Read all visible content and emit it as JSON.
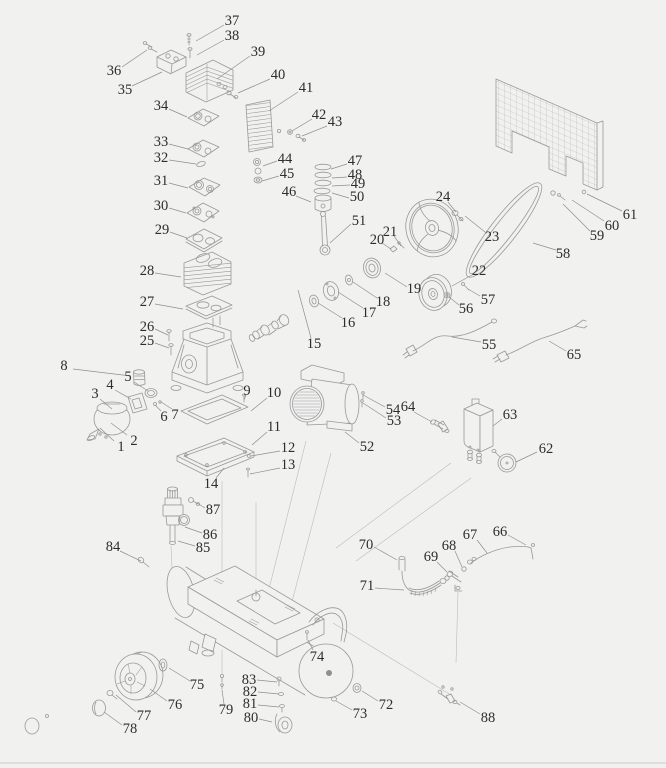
{
  "diagram": {
    "subject": "Air compressor exploded parts diagram",
    "type": "exploded-parts-diagram",
    "part_count": 88,
    "background_color": "#f1f1ef",
    "part_line_color": "#97999b",
    "leader_line_color": "#8d8f91",
    "construction_line_color": "#bcbcba",
    "label_color": "#2d2d2d",
    "label_font_size": 14.5,
    "bottom_rule_color": "#c9c9c7",
    "labels": [
      {
        "n": "1",
        "x": 121,
        "y": 447,
        "l": [
          114,
          441,
          100,
          428
        ]
      },
      {
        "n": "2",
        "x": 134,
        "y": 441,
        "l": [
          127,
          435,
          111,
          423
        ]
      },
      {
        "n": "3",
        "x": 95,
        "y": 394,
        "l": [
          100,
          399,
          112,
          409
        ]
      },
      {
        "n": "4",
        "x": 110,
        "y": 385,
        "l": [
          115,
          390,
          131,
          399
        ]
      },
      {
        "n": "5",
        "x": 128,
        "y": 377,
        "l": [
          134,
          382,
          148,
          391
        ]
      },
      {
        "n": "6",
        "x": 164,
        "y": 417,
        "l": [
          161,
          411,
          155,
          405
        ]
      },
      {
        "n": "7",
        "x": 175,
        "y": 415,
        "l": [
          172,
          409,
          161,
          402
        ]
      },
      {
        "n": "8",
        "x": 64,
        "y": 366,
        "l": [
          73,
          369,
          131,
          376
        ]
      },
      {
        "n": "9",
        "x": 247,
        "y": 391,
        "l": [
          246,
          395,
          244,
          400
        ]
      },
      {
        "n": "10",
        "x": 274,
        "y": 393,
        "l": [
          267,
          398,
          251,
          411
        ]
      },
      {
        "n": "11",
        "x": 274,
        "y": 427,
        "l": [
          267,
          432,
          252,
          445
        ]
      },
      {
        "n": "12",
        "x": 288,
        "y": 448,
        "l": [
          280,
          451,
          251,
          456
        ]
      },
      {
        "n": "13",
        "x": 288,
        "y": 465,
        "l": [
          280,
          468,
          250,
          474
        ]
      },
      {
        "n": "14",
        "x": 211,
        "y": 484,
        "l": [
          216,
          478,
          224,
          468
        ]
      },
      {
        "n": "15",
        "x": 314,
        "y": 344,
        "l": [
          311,
          338,
          298,
          290
        ]
      },
      {
        "n": "16",
        "x": 348,
        "y": 323,
        "l": [
          342,
          318,
          318,
          303
        ]
      },
      {
        "n": "17",
        "x": 369,
        "y": 313,
        "l": [
          363,
          308,
          338,
          292
        ]
      },
      {
        "n": "18",
        "x": 383,
        "y": 302,
        "l": [
          377,
          298,
          353,
          282
        ]
      },
      {
        "n": "19",
        "x": 414,
        "y": 289,
        "l": [
          407,
          287,
          385,
          273
        ]
      },
      {
        "n": "20",
        "x": 377,
        "y": 240,
        "l": [
          382,
          243,
          391,
          249
        ]
      },
      {
        "n": "21",
        "x": 390,
        "y": 232,
        "l": [
          394,
          236,
          401,
          246
        ]
      },
      {
        "n": "22",
        "x": 479,
        "y": 271,
        "l": [
          472,
          275,
          452,
          286
        ]
      },
      {
        "n": "23",
        "x": 492,
        "y": 237,
        "l": [
          485,
          232,
          465,
          216
        ]
      },
      {
        "n": "24",
        "x": 443,
        "y": 197,
        "l": [
          448,
          202,
          456,
          212
        ]
      },
      {
        "n": "25",
        "x": 147,
        "y": 341,
        "l": [
          155,
          343,
          169,
          348
        ]
      },
      {
        "n": "26",
        "x": 147,
        "y": 327,
        "l": [
          155,
          329,
          168,
          335
        ]
      },
      {
        "n": "27",
        "x": 147,
        "y": 302,
        "l": [
          155,
          304,
          183,
          309
        ]
      },
      {
        "n": "28",
        "x": 147,
        "y": 271,
        "l": [
          155,
          273,
          181,
          277
        ]
      },
      {
        "n": "29",
        "x": 162,
        "y": 230,
        "l": [
          170,
          232,
          187,
          238
        ]
      },
      {
        "n": "30",
        "x": 161,
        "y": 206,
        "l": [
          169,
          208,
          186,
          213
        ]
      },
      {
        "n": "31",
        "x": 161,
        "y": 181,
        "l": [
          169,
          183,
          188,
          188
        ]
      },
      {
        "n": "32",
        "x": 161,
        "y": 158,
        "l": [
          169,
          160,
          196,
          164
        ]
      },
      {
        "n": "33",
        "x": 161,
        "y": 142,
        "l": [
          169,
          144,
          188,
          149
        ]
      },
      {
        "n": "34",
        "x": 161,
        "y": 106,
        "l": [
          169,
          109,
          187,
          117
        ]
      },
      {
        "n": "35",
        "x": 125,
        "y": 90,
        "l": [
          132,
          86,
          162,
          72
        ]
      },
      {
        "n": "36",
        "x": 114,
        "y": 71,
        "l": [
          122,
          67,
          147,
          50
        ]
      },
      {
        "n": "37",
        "x": 232,
        "y": 21,
        "l": [
          224,
          25,
          196,
          41
        ]
      },
      {
        "n": "38",
        "x": 232,
        "y": 36,
        "l": [
          224,
          40,
          197,
          55
        ]
      },
      {
        "n": "39",
        "x": 258,
        "y": 52,
        "l": [
          250,
          56,
          217,
          79
        ]
      },
      {
        "n": "40",
        "x": 278,
        "y": 75,
        "l": [
          270,
          79,
          238,
          93
        ]
      },
      {
        "n": "41",
        "x": 306,
        "y": 88,
        "l": [
          298,
          92,
          269,
          111
        ]
      },
      {
        "n": "42",
        "x": 319,
        "y": 115,
        "l": [
          312,
          119,
          292,
          131
        ]
      },
      {
        "n": "43",
        "x": 335,
        "y": 122,
        "l": [
          327,
          126,
          302,
          136
        ]
      },
      {
        "n": "44",
        "x": 285,
        "y": 159,
        "l": [
          277,
          161,
          263,
          166
        ]
      },
      {
        "n": "45",
        "x": 287,
        "y": 174,
        "l": [
          279,
          176,
          262,
          181
        ]
      },
      {
        "n": "46",
        "x": 289,
        "y": 192,
        "l": [
          296,
          196,
          311,
          202
        ]
      },
      {
        "n": "47",
        "x": 355,
        "y": 161,
        "l": [
          347,
          164,
          331,
          169
        ]
      },
      {
        "n": "48",
        "x": 355,
        "y": 175,
        "l": [
          347,
          177,
          332,
          178
        ]
      },
      {
        "n": "49",
        "x": 358,
        "y": 184,
        "l": [
          350,
          185,
          332,
          186
        ]
      },
      {
        "n": "50",
        "x": 357,
        "y": 197,
        "l": [
          349,
          198,
          332,
          193
        ]
      },
      {
        "n": "51",
        "x": 359,
        "y": 221,
        "l": [
          351,
          224,
          330,
          243
        ]
      },
      {
        "n": "52",
        "x": 367,
        "y": 447,
        "l": [
          359,
          443,
          345,
          432
        ]
      },
      {
        "n": "53",
        "x": 394,
        "y": 421,
        "l": [
          386,
          418,
          363,
          403
        ]
      },
      {
        "n": "54",
        "x": 393,
        "y": 410,
        "l": [
          385,
          407,
          363,
          395
        ]
      },
      {
        "n": "55",
        "x": 489,
        "y": 345,
        "l": [
          481,
          342,
          452,
          337
        ]
      },
      {
        "n": "56",
        "x": 466,
        "y": 309,
        "l": [
          459,
          305,
          449,
          297
        ]
      },
      {
        "n": "57",
        "x": 488,
        "y": 300,
        "l": [
          480,
          296,
          468,
          289
        ]
      },
      {
        "n": "58",
        "x": 563,
        "y": 254,
        "l": [
          556,
          250,
          533,
          243
        ]
      },
      {
        "n": "59",
        "x": 597,
        "y": 236,
        "l": [
          590,
          231,
          563,
          204
        ]
      },
      {
        "n": "60",
        "x": 612,
        "y": 226,
        "l": [
          604,
          221,
          572,
          200
        ]
      },
      {
        "n": "61",
        "x": 630,
        "y": 215,
        "l": [
          622,
          211,
          587,
          194
        ]
      },
      {
        "n": "62",
        "x": 546,
        "y": 449,
        "l": [
          537,
          452,
          516,
          462
        ]
      },
      {
        "n": "63",
        "x": 510,
        "y": 415,
        "l": [
          502,
          419,
          493,
          426
        ]
      },
      {
        "n": "64",
        "x": 408,
        "y": 407,
        "l": [
          414,
          412,
          432,
          422
        ]
      },
      {
        "n": "65",
        "x": 574,
        "y": 355,
        "l": [
          566,
          351,
          549,
          341
        ]
      },
      {
        "n": "66",
        "x": 500,
        "y": 532,
        "l": [
          508,
          535,
          526,
          545
        ]
      },
      {
        "n": "67",
        "x": 470,
        "y": 535,
        "l": [
          477,
          540,
          487,
          553
        ]
      },
      {
        "n": "68",
        "x": 449,
        "y": 546,
        "l": [
          455,
          551,
          462,
          567
        ]
      },
      {
        "n": "69",
        "x": 431,
        "y": 557,
        "l": [
          437,
          562,
          447,
          572
        ]
      },
      {
        "n": "70",
        "x": 366,
        "y": 545,
        "l": [
          374,
          547,
          397,
          560
        ]
      },
      {
        "n": "71",
        "x": 367,
        "y": 586,
        "l": [
          375,
          588,
          404,
          590
        ]
      },
      {
        "n": "72",
        "x": 386,
        "y": 705,
        "l": [
          378,
          701,
          362,
          691
        ]
      },
      {
        "n": "73",
        "x": 360,
        "y": 714,
        "l": [
          352,
          710,
          336,
          701
        ]
      },
      {
        "n": "74",
        "x": 317,
        "y": 657,
        "l": [
          313,
          650,
          308,
          640
        ]
      },
      {
        "n": "75",
        "x": 197,
        "y": 685,
        "l": [
          190,
          681,
          169,
          668
        ]
      },
      {
        "n": "76",
        "x": 175,
        "y": 705,
        "l": [
          167,
          701,
          150,
          689
        ]
      },
      {
        "n": "77",
        "x": 144,
        "y": 716,
        "l": [
          136,
          712,
          116,
          695
        ]
      },
      {
        "n": "78",
        "x": 130,
        "y": 729,
        "l": [
          122,
          725,
          104,
          712
        ]
      },
      {
        "n": "79",
        "x": 226,
        "y": 710,
        "l": [
          224,
          704,
          222,
          690
        ]
      },
      {
        "n": "80",
        "x": 251,
        "y": 718,
        "l": [
          259,
          719,
          272,
          722
        ]
      },
      {
        "n": "81",
        "x": 250,
        "y": 704,
        "l": [
          258,
          705,
          279,
          707
        ]
      },
      {
        "n": "82",
        "x": 250,
        "y": 692,
        "l": [
          258,
          692,
          279,
          694
        ]
      },
      {
        "n": "83",
        "x": 249,
        "y": 680,
        "l": [
          257,
          680,
          277,
          682
        ]
      },
      {
        "n": "84",
        "x": 113,
        "y": 547,
        "l": [
          120,
          551,
          141,
          561
        ]
      },
      {
        "n": "85",
        "x": 203,
        "y": 548,
        "l": [
          195,
          546,
          178,
          541
        ]
      },
      {
        "n": "86",
        "x": 210,
        "y": 535,
        "l": [
          202,
          533,
          185,
          527
        ]
      },
      {
        "n": "87",
        "x": 213,
        "y": 510,
        "l": [
          205,
          508,
          197,
          503
        ]
      },
      {
        "n": "88",
        "x": 488,
        "y": 718,
        "l": [
          480,
          714,
          460,
          702
        ]
      }
    ],
    "construction_lines": [
      [
        458,
        592,
        456,
        663
      ],
      [
        333,
        623,
        451,
        695
      ],
      [
        222,
        481,
        222,
        598
      ],
      [
        222,
        650,
        222,
        674
      ],
      [
        256,
        502,
        256,
        590
      ],
      [
        306,
        441,
        266,
        601
      ],
      [
        331,
        453,
        288,
        617
      ],
      [
        171,
        546,
        172,
        569
      ],
      [
        451,
        463,
        336,
        548
      ],
      [
        471,
        478,
        356,
        561
      ]
    ]
  }
}
